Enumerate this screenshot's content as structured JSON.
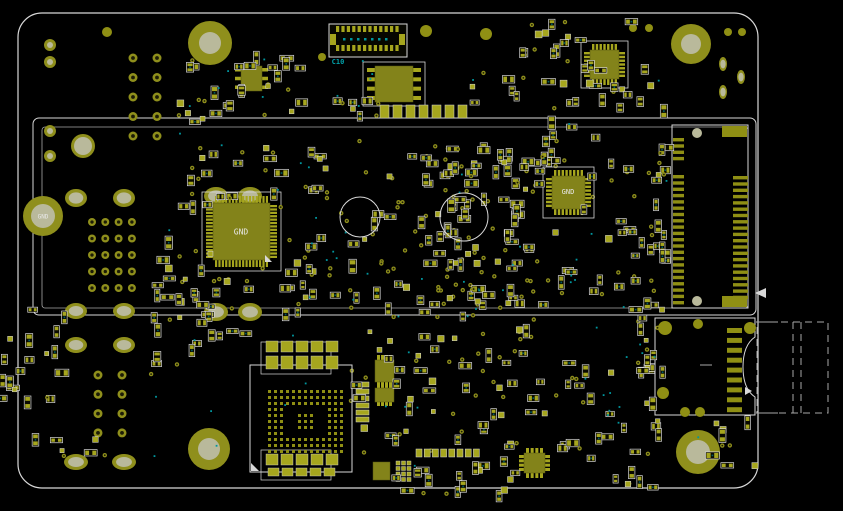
{
  "canvas": {
    "width": 843,
    "height": 511,
    "background": "#000000"
  },
  "colors": {
    "bg": "#000000",
    "silk": "#d8d8d8",
    "silk_dim": "#a8a8a8",
    "pad": "#a6a61e",
    "pad_dark": "#8f8f14",
    "body": "#83831a",
    "hole_ring": "#8f8f1c",
    "hole_center": "#b9b99b",
    "via": "#8f8f1c",
    "via_center": "#1c1c06",
    "teal": "#00969e",
    "teal_dark": "#015f66",
    "text_white": "#e9e9e9"
  },
  "labels": {
    "hole_gnd": "GND",
    "qfp_gnd": "GND",
    "qfn_gnd": "GND",
    "c10": "C10"
  },
  "board": {
    "outline": [
      18,
      13,
      740,
      475,
      24
    ],
    "module_outer": [
      33,
      118,
      723,
      197
    ],
    "module_inner": [
      42,
      127,
      706,
      181
    ]
  },
  "holes": [
    [
      210,
      43,
      22,
      11
    ],
    [
      691,
      44,
      20,
      10
    ],
    [
      209,
      449,
      21,
      11
    ],
    [
      698,
      452,
      22,
      12
    ],
    [
      83,
      146,
      12,
      9
    ]
  ],
  "gnd_hole": [
    43,
    216,
    20,
    12
  ],
  "ring_circles": [
    [
      50,
      45,
      6,
      3
    ],
    [
      50,
      62,
      6,
      3
    ],
    [
      50,
      131,
      6,
      3
    ],
    [
      50,
      156,
      6,
      3
    ]
  ],
  "solid_circles": [
    [
      107,
      32,
      5
    ],
    [
      426,
      31,
      6
    ],
    [
      486,
      34,
      6
    ],
    [
      633,
      28,
      4
    ],
    [
      649,
      28,
      4
    ],
    [
      728,
      32,
      4
    ],
    [
      742,
      32,
      4
    ],
    [
      322,
      57,
      4
    ]
  ],
  "ovals": [
    [
      76,
      198,
      11,
      9
    ],
    [
      124,
      198,
      11,
      9
    ],
    [
      216,
      196,
      12,
      9
    ],
    [
      250,
      196,
      12,
      9
    ],
    [
      216,
      312,
      12,
      9
    ],
    [
      250,
      312,
      12,
      9
    ],
    [
      76,
      311,
      11,
      8
    ],
    [
      124,
      311,
      11,
      8
    ],
    [
      76,
      345,
      11,
      8
    ],
    [
      124,
      345,
      11,
      8
    ],
    [
      76,
      462,
      12,
      8
    ],
    [
      124,
      462,
      12,
      8
    ],
    [
      723,
      64,
      4,
      7
    ],
    [
      741,
      77,
      4,
      7
    ],
    [
      723,
      92,
      4,
      7
    ]
  ],
  "via_grids": [
    [
      133,
      58,
      2,
      5,
      24,
      19.5,
      4.5
    ],
    [
      92,
      222,
      4,
      5,
      13.3,
      16.5,
      4
    ],
    [
      98,
      375,
      2,
      4,
      24,
      19.3,
      4.5
    ]
  ],
  "silk_circles": [
    [
      360,
      217,
      20
    ],
    [
      464,
      217,
      24
    ]
  ],
  "chips": [
    {
      "name": "qfp-chip-u1",
      "body": [
        213,
        203,
        57,
        57
      ],
      "pins": {
        "type": "quad",
        "n": 16,
        "len": 7,
        "w": 2.2
      },
      "outline": [
        202,
        192,
        79,
        79
      ]
    },
    {
      "name": "qfn-chip-u2",
      "body": [
        552,
        176,
        33,
        33
      ],
      "pins": {
        "type": "quad",
        "n": 8,
        "len": 6,
        "w": 2.4
      },
      "outline": [
        543,
        167,
        51,
        51
      ]
    },
    {
      "name": "qfn-chip-u3",
      "body": [
        590,
        50,
        29,
        29
      ],
      "pins": {
        "type": "quad",
        "n": 7,
        "len": 6,
        "w": 2.4
      },
      "outline": [
        581,
        41,
        47,
        47
      ]
    },
    {
      "name": "soic-chip-u4",
      "body": [
        375,
        66,
        38,
        36
      ],
      "pins": {
        "type": "dual",
        "n": 4,
        "len": 8,
        "w": 4
      },
      "outline": [
        363,
        62,
        62,
        44
      ]
    },
    {
      "name": "sot-chip-u5",
      "body": [
        241,
        66,
        21,
        25
      ],
      "pins": {
        "type": "dual",
        "n": 3,
        "len": 6,
        "w": 3.5
      }
    },
    {
      "name": "ic-chip-u6",
      "body": [
        375,
        360,
        19,
        22
      ],
      "pins": {
        "type": "dualtb",
        "n": 4,
        "len": 5,
        "w": 3
      }
    },
    {
      "name": "ic-chip-u7",
      "body": [
        375,
        388,
        19,
        14
      ],
      "pins": {
        "type": "dualtb",
        "n": 4,
        "len": 4,
        "w": 3
      }
    },
    {
      "name": "ic-chip-u8",
      "body": [
        524,
        453,
        21,
        20
      ],
      "pins": {
        "type": "quad",
        "n": 4,
        "len": 5,
        "w": 3
      }
    },
    {
      "name": "ic-chip-u9",
      "body": [
        373,
        462,
        17,
        18
      ],
      "pins": {
        "type": "none"
      }
    }
  ],
  "pad_grid": {
    "x0": 396,
    "y0": 461,
    "cols": 3,
    "rows": 4,
    "pitch": 5.5,
    "size": 4
  },
  "pad_rows": [
    [
      380,
      105,
      7,
      9,
      13,
      13,
      0
    ],
    [
      416,
      449,
      8,
      6,
      8.2,
      8,
      0
    ],
    [
      356,
      382,
      6,
      13,
      7,
      5,
      1
    ]
  ],
  "fpc_connector": {
    "outline": [
      329,
      24,
      78,
      33
    ],
    "pads_top": {
      "x0": 336,
      "y": 26,
      "n": 12,
      "pw": 3.2,
      "ph": 6,
      "pitch": 5.4
    },
    "pads_bottom": {
      "x0": 336,
      "y": 45,
      "n": 12,
      "pw": 3.2,
      "ph": 6,
      "pitch": 5.4
    },
    "side_pads": [
      [
        330,
        34,
        6,
        11
      ],
      [
        399,
        34,
        6,
        11
      ]
    ]
  },
  "bga": {
    "outline": [
      250,
      365,
      102,
      107
    ],
    "grid": {
      "x0": 268,
      "y0": 390,
      "cols": 13,
      "rows": 11,
      "pitch": 6,
      "size": 3,
      "ring": 3,
      "center_block": [
        5,
        4,
        3,
        3
      ]
    },
    "rows_above": [
      [
        266,
        341,
        5,
        12,
        15,
        11
      ],
      [
        266,
        356,
        5,
        12,
        15,
        13
      ]
    ],
    "rows_below": [
      [
        266,
        454,
        5,
        12,
        15,
        11
      ],
      [
        268,
        468,
        5,
        11,
        14,
        8
      ]
    ],
    "brackets": [
      [
        261,
        342,
        70,
        32
      ],
      [
        261,
        450,
        70,
        30
      ]
    ]
  },
  "edge_connector": {
    "outline": [
      672,
      125,
      76,
      183
    ],
    "left_col": {
      "x": 673,
      "w": 11,
      "h": 3.4,
      "pitch": 6.3,
      "runs": [
        [
          138,
          4
        ],
        [
          175,
          21
        ]
      ]
    },
    "right_col": {
      "x": 733,
      "w": 15,
      "h": 3.4,
      "pitch": 6.3,
      "runs": [
        [
          176,
          20
        ]
      ]
    },
    "wide_pads": [
      [
        722,
        126,
        25,
        11
      ],
      [
        722,
        296,
        25,
        11
      ]
    ],
    "holes": [
      [
        697,
        133,
        5
      ],
      [
        697,
        301,
        5
      ]
    ]
  },
  "sd_connector": {
    "body": [
      655,
      318,
      100,
      97
    ],
    "cutout": {
      "y1": 337,
      "y2": 397,
      "depth": 12
    },
    "corner_pads": [
      [
        665,
        328,
        7
      ],
      [
        698,
        324,
        5
      ],
      [
        750,
        328,
        6
      ],
      [
        663,
        393,
        6
      ],
      [
        685,
        412,
        5
      ],
      [
        700,
        412,
        5
      ]
    ],
    "contacts": {
      "x": 727,
      "w": 15,
      "h": 5,
      "pitch": 9.9,
      "n": 9,
      "y0": 328
    },
    "card_dashed_rect": [
      757,
      322,
      71,
      91
    ],
    "dashed_vlines": [
      [
        793,
        322,
        413
      ],
      [
        801,
        322,
        413
      ]
    ],
    "solid_lines": [
      [
        756,
        322,
        778,
        322
      ],
      [
        756,
        413,
        778,
        413
      ],
      [
        700,
        365,
        712,
        365
      ]
    ]
  },
  "clusters": [
    [
      178,
      58,
      125,
      62,
      22,
      1
    ],
    [
      470,
      22,
      118,
      88,
      20,
      2
    ],
    [
      545,
      18,
      120,
      95,
      22,
      3
    ],
    [
      152,
      148,
      60,
      170,
      18,
      4
    ],
    [
      190,
      148,
      145,
      52,
      22,
      6
    ],
    [
      280,
      200,
      60,
      115,
      14,
      7
    ],
    [
      150,
      265,
      185,
      55,
      20,
      8
    ],
    [
      350,
      140,
      135,
      180,
      55,
      9
    ],
    [
      420,
      150,
      115,
      165,
      45,
      10
    ],
    [
      490,
      115,
      120,
      75,
      16,
      11
    ],
    [
      500,
      150,
      170,
      160,
      30,
      12
    ],
    [
      590,
      225,
      80,
      85,
      14,
      13
    ],
    [
      150,
      318,
      105,
      60,
      12,
      14
    ],
    [
      18,
      300,
      48,
      148,
      14,
      15
    ],
    [
      0,
      328,
      16,
      75,
      7,
      16
    ],
    [
      350,
      330,
      125,
      100,
      22,
      17
    ],
    [
      355,
      425,
      170,
      75,
      28,
      18
    ],
    [
      478,
      318,
      185,
      115,
      35,
      19
    ],
    [
      545,
      428,
      120,
      62,
      16,
      20
    ],
    [
      640,
      315,
      22,
      118,
      10,
      21
    ],
    [
      656,
      128,
      15,
      178,
      13,
      22
    ],
    [
      712,
      420,
      48,
      50,
      9,
      23
    ],
    [
      175,
      88,
      60,
      35,
      8,
      24
    ],
    [
      330,
      93,
      50,
      28,
      8,
      25
    ],
    [
      60,
      432,
      60,
      28,
      5,
      26
    ]
  ],
  "via_scatter": [
    [
      340,
      140,
      150,
      180,
      26,
      31
    ],
    [
      420,
      150,
      130,
      170,
      22,
      32
    ],
    [
      180,
      150,
      150,
      160,
      14,
      33
    ],
    [
      480,
      320,
      170,
      100,
      12,
      34
    ],
    [
      350,
      330,
      130,
      140,
      12,
      35
    ],
    [
      520,
      140,
      140,
      160,
      12,
      36
    ]
  ],
  "teal_scatter": [
    [
      150,
      55,
      520,
      430,
      60,
      77
    ],
    [
      540,
      320,
      160,
      120,
      12,
      78
    ]
  ],
  "triangles": [
    [
      [
        265,
        255
      ],
      [
        265,
        262
      ],
      [
        272,
        262
      ]
    ],
    [
      [
        251,
        471
      ],
      [
        251,
        463
      ],
      [
        259,
        471
      ]
    ],
    [
      [
        766,
        288
      ],
      [
        766,
        298
      ],
      [
        755,
        293
      ]
    ],
    [
      [
        745,
        387
      ],
      [
        752,
        391
      ],
      [
        745,
        395
      ]
    ]
  ],
  "label_positions": {
    "hole_gnd": [
      43,
      217
    ],
    "qfp_gnd": [
      241,
      232
    ],
    "qfn_gnd": [
      568,
      192
    ],
    "c10": [
      338,
      62
    ]
  }
}
